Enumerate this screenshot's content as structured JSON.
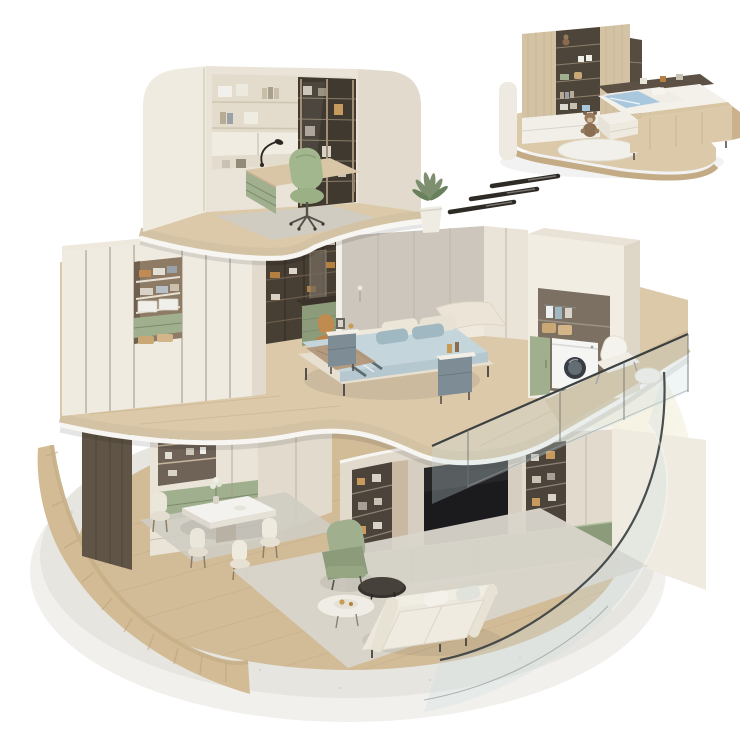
{
  "scene": {
    "type": "isometric-3d-cutaway-render",
    "description": "Three-storey circular apartment cutaway model on a round concrete plinth, with a separate kids-bedroom vignette at top right linked by three motion dashes",
    "floors": [
      {
        "name": "top-floor-study",
        "items": [
          "curved-cream-walls",
          "wall-shelving-with-books-and-boxes",
          "glass-door-bookcase",
          "desk-with-green-drawers",
          "desk-lamp",
          "laptop",
          "green-office-chair",
          "gray-area-rug",
          "wood-floor-slab"
        ]
      },
      {
        "name": "middle-floor-bedroom",
        "items": [
          "cream-wardrobe-wall",
          "open-wardrobe-shelves-with-clothes-baskets",
          "bronze-open-shelving",
          "vanity-desk-green-drawers",
          "vanity-chair",
          "fabric-accent-wall",
          "double-bed-blue-bedding",
          "striped-bed-runner",
          "tan-throw",
          "two-nightstands",
          "laundry-niche",
          "washing-machine",
          "green-cabinet-door",
          "balcony-wood-deck",
          "glass-balustrade",
          "lounge-chair-with-pouf",
          "potted-plant"
        ]
      },
      {
        "name": "ground-floor-living-dining",
        "items": [
          "fluted-curved-wood-wall",
          "dark-wood-panel",
          "china-cabinet-with-glassware",
          "green-drawer-band",
          "marble-dining-table",
          "vase-of-flowers",
          "four-cream-dining-chairs",
          "dining-rug",
          "tv-media-wall",
          "tv-screen",
          "lit-display-shelves",
          "green-base-cabinets",
          "green-recliner-armchair",
          "cream-three-seat-sofa",
          "round-marble-coffee-table",
          "round-dark-side-table",
          "living-room-rug",
          "curved-glass-wall",
          "round-concrete-base"
        ]
      }
    ],
    "inset": {
      "name": "kids-bedroom-vignette",
      "items": [
        "toy-wardrobe-with-cubbies",
        "plush-toys",
        "white-drawer-base",
        "storage-platform-bed",
        "blue-bedding",
        "headboard-shelf",
        "teddy-bear",
        "round-rug",
        "wood-platform",
        "curved-wall-stub"
      ]
    },
    "connector": {
      "name": "motion-dashes",
      "count": 3
    }
  },
  "colors": {
    "background": "#ffffff",
    "glow": "#f6f2e2",
    "base_top": "#e6e5e0",
    "base_side": "#f1f0ed",
    "wood_floor": "#d2bc98",
    "wood_floor_light": "#dbc9a9",
    "wood_slab": "#d3c3a4",
    "fluted_wood": "#d3bc95",
    "fluted_stripe": "#bfa47b",
    "cream_wall": "#f0ebe1",
    "cream_shade": "#e2dbcd",
    "cream_panel": "#eae4d8",
    "dark_wood": "#5f5446",
    "shelf_dark": "#4c443b",
    "sage": "#a0af8d",
    "sage_dark": "#8c9c7b",
    "bronze_box": "#b5803f",
    "bed_blue": "#c4d5db",
    "pillow_blue": "#9fb8c2",
    "throw_tan": "#b3987a",
    "nightstand_teal": "#7e8d95",
    "tv_black": "#1b1b1d",
    "glass_tint": "rgba(206,221,224,0.30)",
    "glass_edge": "#3b4041",
    "rug_gray": "#cfccc3",
    "rug_light": "#d9d5cb",
    "inset_wood": "#dcc9a9",
    "inset_blue": "#a9c7dd",
    "dash": "#2e2b27",
    "white_trim": "#f7f6f2"
  }
}
